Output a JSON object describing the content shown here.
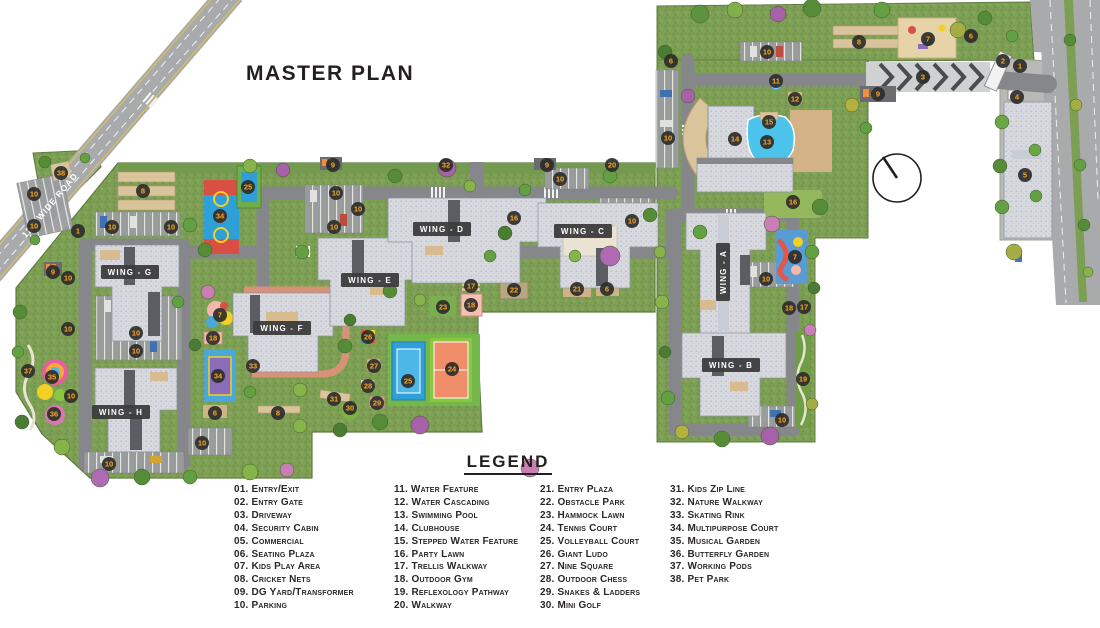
{
  "title": "MASTER PLAN",
  "map": {
    "road_label": "12M WIDE ROAD",
    "wings": [
      {
        "label": "WING - G",
        "x": 130,
        "y": 272,
        "rot": 0
      },
      {
        "label": "WING - H",
        "x": 121,
        "y": 412,
        "rot": 0
      },
      {
        "label": "WING - F",
        "x": 282,
        "y": 328,
        "rot": 0
      },
      {
        "label": "WING - E",
        "x": 370,
        "y": 280,
        "rot": 0
      },
      {
        "label": "WING - D",
        "x": 442,
        "y": 229,
        "rot": 0
      },
      {
        "label": "WING - C",
        "x": 583,
        "y": 231,
        "rot": 0
      },
      {
        "label": "WING - A",
        "x": 723,
        "y": 272,
        "rot": -90
      },
      {
        "label": "WING - B",
        "x": 731,
        "y": 365,
        "rot": 0
      }
    ],
    "markers": [
      {
        "n": "38",
        "x": 61,
        "y": 173
      },
      {
        "n": "1",
        "x": 78,
        "y": 231
      },
      {
        "n": "9",
        "x": 53,
        "y": 272
      },
      {
        "n": "10",
        "x": 68,
        "y": 278
      },
      {
        "n": "10",
        "x": 34,
        "y": 194
      },
      {
        "n": "10",
        "x": 34,
        "y": 226
      },
      {
        "n": "10",
        "x": 112,
        "y": 227
      },
      {
        "n": "10",
        "x": 171,
        "y": 227
      },
      {
        "n": "8",
        "x": 143,
        "y": 191
      },
      {
        "n": "34",
        "x": 220,
        "y": 216
      },
      {
        "n": "25",
        "x": 248,
        "y": 187
      },
      {
        "n": "10",
        "x": 336,
        "y": 193
      },
      {
        "n": "10",
        "x": 358,
        "y": 209
      },
      {
        "n": "10",
        "x": 334,
        "y": 227
      },
      {
        "n": "9",
        "x": 333,
        "y": 165
      },
      {
        "n": "32",
        "x": 446,
        "y": 165
      },
      {
        "n": "9",
        "x": 547,
        "y": 165
      },
      {
        "n": "20",
        "x": 612,
        "y": 165
      },
      {
        "n": "10",
        "x": 560,
        "y": 179
      },
      {
        "n": "16",
        "x": 514,
        "y": 218
      },
      {
        "n": "10",
        "x": 632,
        "y": 221
      },
      {
        "n": "10",
        "x": 68,
        "y": 329
      },
      {
        "n": "10",
        "x": 136,
        "y": 333
      },
      {
        "n": "10",
        "x": 136,
        "y": 351
      },
      {
        "n": "35",
        "x": 52,
        "y": 377
      },
      {
        "n": "37",
        "x": 28,
        "y": 371
      },
      {
        "n": "10",
        "x": 71,
        "y": 396
      },
      {
        "n": "36",
        "x": 54,
        "y": 414
      },
      {
        "n": "7",
        "x": 220,
        "y": 315
      },
      {
        "n": "18",
        "x": 213,
        "y": 338
      },
      {
        "n": "34",
        "x": 218,
        "y": 376
      },
      {
        "n": "33",
        "x": 253,
        "y": 366
      },
      {
        "n": "6",
        "x": 215,
        "y": 413
      },
      {
        "n": "8",
        "x": 278,
        "y": 413
      },
      {
        "n": "10",
        "x": 202,
        "y": 443
      },
      {
        "n": "10",
        "x": 109,
        "y": 464
      },
      {
        "n": "17",
        "x": 471,
        "y": 286
      },
      {
        "n": "22",
        "x": 514,
        "y": 290
      },
      {
        "n": "21",
        "x": 577,
        "y": 289
      },
      {
        "n": "6",
        "x": 607,
        "y": 289
      },
      {
        "n": "23",
        "x": 443,
        "y": 307
      },
      {
        "n": "18",
        "x": 471,
        "y": 305
      },
      {
        "n": "26",
        "x": 368,
        "y": 337
      },
      {
        "n": "27",
        "x": 374,
        "y": 366
      },
      {
        "n": "28",
        "x": 368,
        "y": 386
      },
      {
        "n": "29",
        "x": 377,
        "y": 403
      },
      {
        "n": "30",
        "x": 350,
        "y": 408
      },
      {
        "n": "31",
        "x": 334,
        "y": 399
      },
      {
        "n": "25",
        "x": 408,
        "y": 381
      },
      {
        "n": "24",
        "x": 452,
        "y": 369
      },
      {
        "n": "6",
        "x": 671,
        "y": 61
      },
      {
        "n": "10",
        "x": 767,
        "y": 52
      },
      {
        "n": "8",
        "x": 859,
        "y": 42
      },
      {
        "n": "7",
        "x": 928,
        "y": 39
      },
      {
        "n": "6",
        "x": 971,
        "y": 36
      },
      {
        "n": "2",
        "x": 1003,
        "y": 61
      },
      {
        "n": "1",
        "x": 1020,
        "y": 66
      },
      {
        "n": "3",
        "x": 923,
        "y": 77
      },
      {
        "n": "9",
        "x": 878,
        "y": 94
      },
      {
        "n": "4",
        "x": 1017,
        "y": 97
      },
      {
        "n": "11",
        "x": 776,
        "y": 81
      },
      {
        "n": "12",
        "x": 795,
        "y": 99
      },
      {
        "n": "15",
        "x": 769,
        "y": 122
      },
      {
        "n": "14",
        "x": 735,
        "y": 139
      },
      {
        "n": "13",
        "x": 767,
        "y": 142
      },
      {
        "n": "10",
        "x": 668,
        "y": 138
      },
      {
        "n": "5",
        "x": 1025,
        "y": 175
      },
      {
        "n": "16",
        "x": 793,
        "y": 202
      },
      {
        "n": "7",
        "x": 795,
        "y": 257
      },
      {
        "n": "10",
        "x": 766,
        "y": 279
      },
      {
        "n": "18",
        "x": 789,
        "y": 308
      },
      {
        "n": "17",
        "x": 804,
        "y": 307
      },
      {
        "n": "19",
        "x": 803,
        "y": 379
      },
      {
        "n": "10",
        "x": 782,
        "y": 420
      }
    ]
  },
  "legend": {
    "title": "LEGEND",
    "columns": [
      [
        {
          "num": "01",
          "label": "Entry/Exit"
        },
        {
          "num": "02",
          "label": "Entry Gate"
        },
        {
          "num": "03",
          "label": "Driveway"
        },
        {
          "num": "04",
          "label": "Security Cabin"
        },
        {
          "num": "05",
          "label": "Commercial"
        },
        {
          "num": "06",
          "label": "Seating Plaza"
        },
        {
          "num": "07",
          "label": "Kids Play Area"
        },
        {
          "num": "08",
          "label": "Cricket Nets"
        },
        {
          "num": "09",
          "label": "DG Yard/Transformer"
        },
        {
          "num": "10",
          "label": "Parking"
        }
      ],
      [
        {
          "num": "11",
          "label": "Water Feature"
        },
        {
          "num": "12",
          "label": "Water Cascading"
        },
        {
          "num": "13",
          "label": "Swimming Pool"
        },
        {
          "num": "14",
          "label": "Clubhouse"
        },
        {
          "num": "15",
          "label": "Stepped Water Feature"
        },
        {
          "num": "16",
          "label": "Party Lawn"
        },
        {
          "num": "17",
          "label": "Trellis Walkway"
        },
        {
          "num": "18",
          "label": "Outdoor Gym"
        },
        {
          "num": "19",
          "label": "Reflexology Pathway"
        },
        {
          "num": "20",
          "label": "Walkway"
        }
      ],
      [
        {
          "num": "21",
          "label": "Entry Plaza"
        },
        {
          "num": "22",
          "label": "Obstacle Park"
        },
        {
          "num": "23",
          "label": "Hammock Lawn"
        },
        {
          "num": "24",
          "label": "Tennis Court"
        },
        {
          "num": "25",
          "label": "Volleyball Court"
        },
        {
          "num": "26",
          "label": "Giant Ludo"
        },
        {
          "num": "27",
          "label": "Nine Square"
        },
        {
          "num": "28",
          "label": "Outdoor Chess"
        },
        {
          "num": "29",
          "label": "Snakes & Ladders"
        },
        {
          "num": "30",
          "label": "Mini Golf"
        }
      ],
      [
        {
          "num": "31",
          "label": "Kids Zip Line"
        },
        {
          "num": "32",
          "label": "Nature Walkway"
        },
        {
          "num": "33",
          "label": "Skating Rink"
        },
        {
          "num": "34",
          "label": "Multipurpose Court"
        },
        {
          "num": "35",
          "label": "Musical Garden"
        },
        {
          "num": "36",
          "label": "Butterfly Garden"
        },
        {
          "num": "37",
          "label": "Working Pods"
        },
        {
          "num": "38",
          "label": "Pet Park"
        }
      ]
    ]
  },
  "colors": {
    "marker_bg": "#2e2d2b",
    "marker_text": "#f8a823",
    "wing_bg": "#3c3c3e",
    "wing_text": "#ffffff",
    "site_green": "#7d9f54",
    "road_gray": "#a8aaac",
    "building_gray": "#d7d9de",
    "pool_blue": "#4cc3ea",
    "court_blue": "#2f9fd8",
    "court_orange": "#ef8e68",
    "text_dark": "#231f20"
  }
}
